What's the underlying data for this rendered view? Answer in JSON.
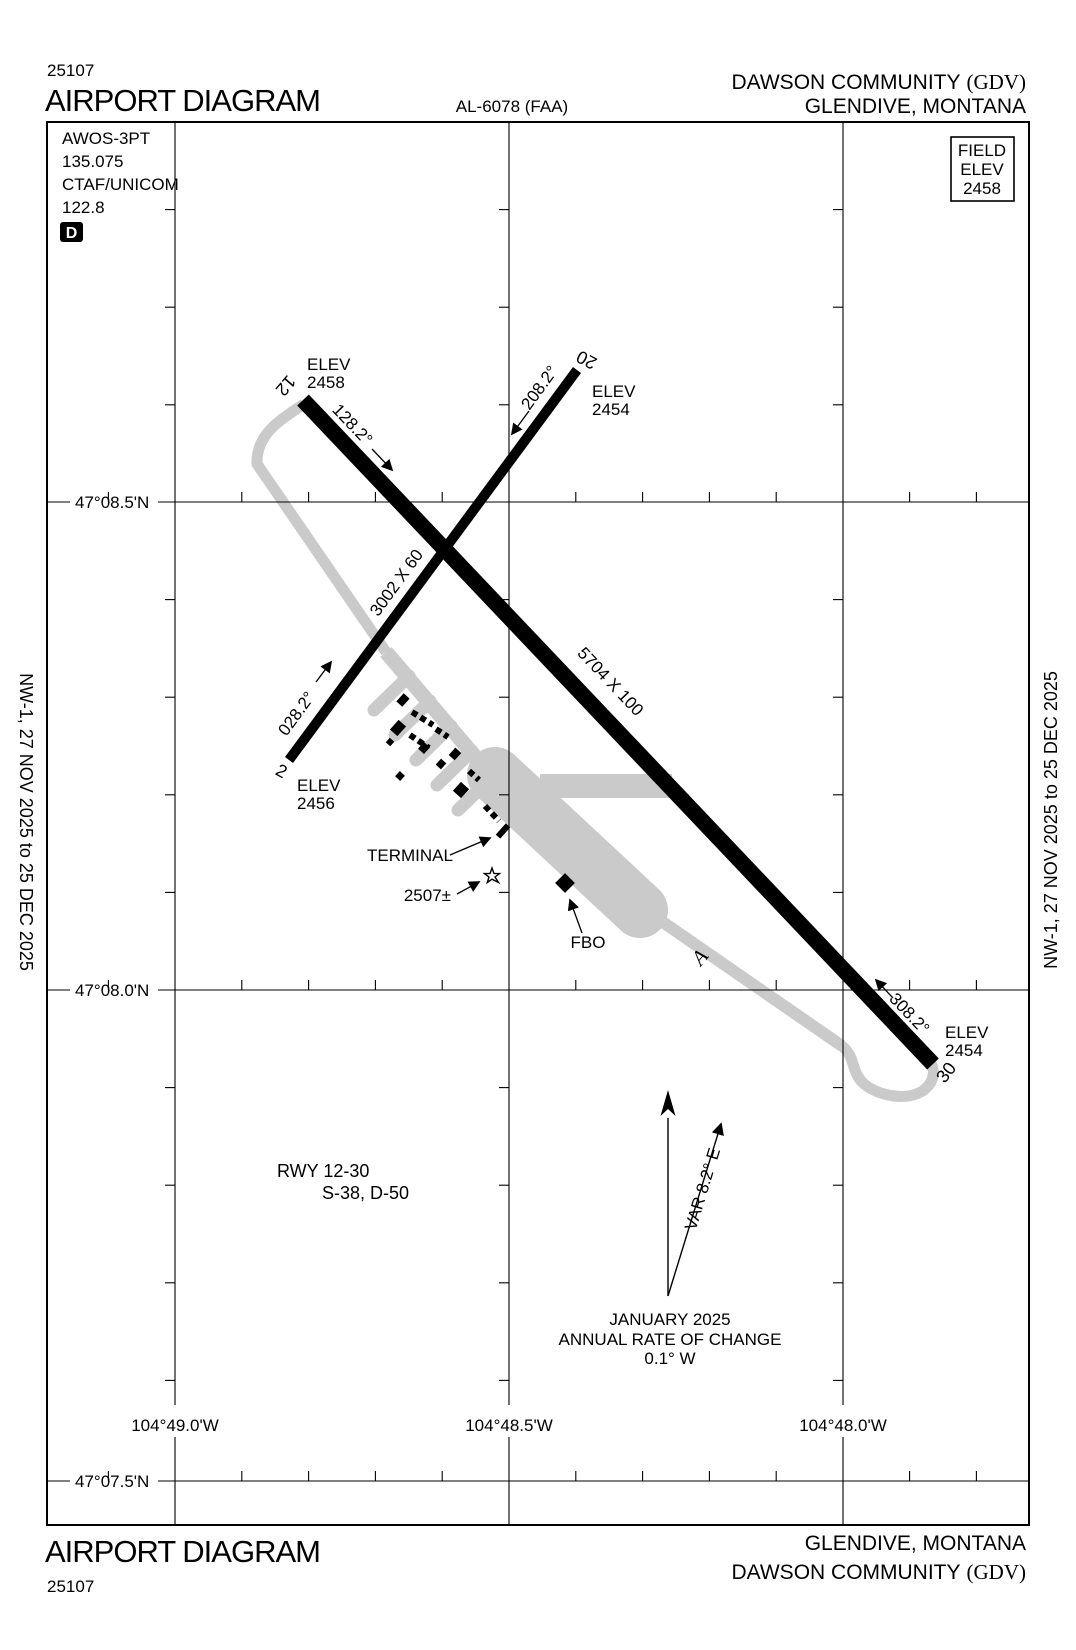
{
  "page": {
    "chart_code_top": "25107",
    "chart_code_bottom": "25107",
    "title_top": "AIRPORT DIAGRAM",
    "title_bottom": "AIRPORT DIAGRAM",
    "procedure_ref": "AL-6078 (FAA)",
    "airport_name": "DAWSON COMMUNITY",
    "airport_id": "(GDV)",
    "city_state": "GLENDIVE, MONTANA"
  },
  "margin_note": "NW-1,  27 NOV 2025  to  25 DEC 2025",
  "info_block": {
    "awos": "AWOS-3PT",
    "awos_freq": "135.075",
    "ctaf": "CTAF/UNICOM",
    "ctaf_freq": "122.8",
    "d_symbol": "D"
  },
  "field_elev": {
    "line1": "FIELD",
    "line2": "ELEV",
    "line3": "2458"
  },
  "runways": {
    "rwy12_30": {
      "dimensions": "5704 X 100",
      "end12": {
        "number": "12",
        "heading": "128.2°",
        "elev_label": "ELEV",
        "elev_value": "2458"
      },
      "end30": {
        "number": "30",
        "heading": "308.2°",
        "elev_label": "ELEV",
        "elev_value": "2454"
      }
    },
    "rwy2_20": {
      "dimensions": "3002 X 60",
      "end2": {
        "number": "2",
        "heading": "028.2°",
        "elev_label": "ELEV",
        "elev_value": "2456"
      },
      "end20": {
        "number": "20",
        "heading": "208.2°",
        "elev_label": "ELEV",
        "elev_value": "2454"
      }
    }
  },
  "features": {
    "terminal": "TERMINAL",
    "fbo": "FBO",
    "taxiway_a": "A",
    "beacon_elev": "2507±"
  },
  "notes": {
    "rwy_line1": "RWY 12-30",
    "rwy_line2": "S-38, D-50",
    "var_label": "VAR 8.2° E",
    "var_date": "JANUARY 2025",
    "rate_line1": "ANNUAL RATE OF CHANGE",
    "rate_line2": "0.1° W"
  },
  "grid": {
    "lat_labels": [
      "47°08.5'N",
      "47°08.0'N",
      "47°07.5'N"
    ],
    "lon_labels": [
      "104°49.0'W",
      "104°48.5'W",
      "104°48.0'W"
    ]
  },
  "colors": {
    "ink": "#000000",
    "taxiway": "#cacaca",
    "paper": "#ffffff"
  }
}
